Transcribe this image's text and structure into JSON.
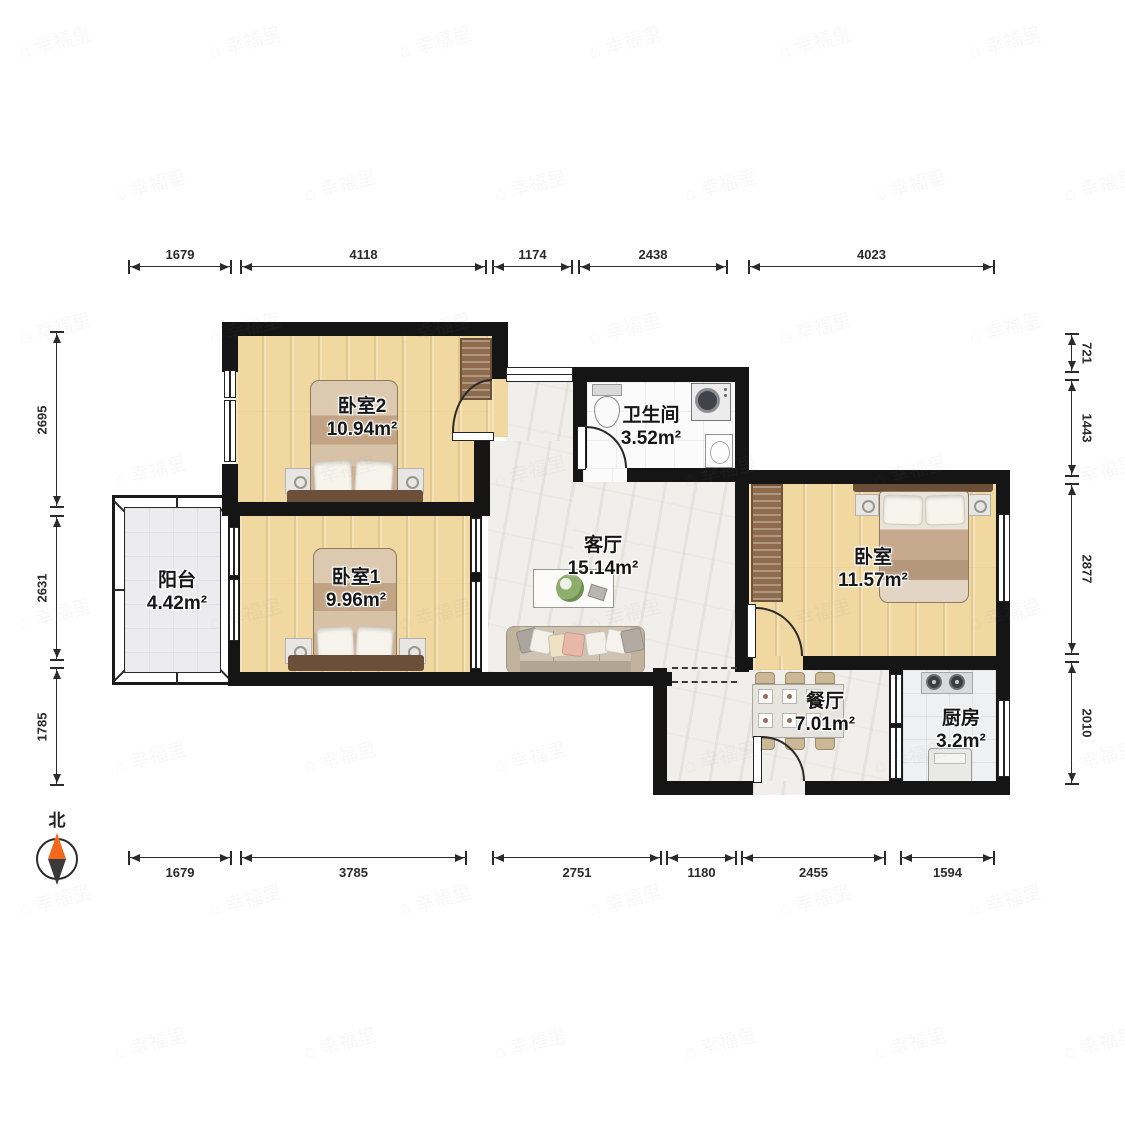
{
  "compass": {
    "north_label": "北"
  },
  "watermark": {
    "icon": "⌂",
    "text": "幸福里"
  },
  "colors": {
    "wall": "#151515",
    "wood_floor": "#f1d7a0",
    "marble_floor": "#f1efec",
    "compass_north": "#f2681c"
  },
  "rooms": [
    {
      "id": "bedroom2",
      "name": "卧室2",
      "area": "10.94m²",
      "cx": 362,
      "cy": 418
    },
    {
      "id": "bedroom1",
      "name": "卧室1",
      "area": "9.96m²",
      "cx": 356,
      "cy": 589
    },
    {
      "id": "balcony",
      "name": "阳台",
      "area": "4.42m²",
      "cx": 177,
      "cy": 592
    },
    {
      "id": "living",
      "name": "客厅",
      "area": "15.14m²",
      "cx": 603,
      "cy": 557
    },
    {
      "id": "bathroom",
      "name": "卫生间",
      "area": "3.52m²",
      "cx": 651,
      "cy": 427
    },
    {
      "id": "bedroom-r",
      "name": "卧室",
      "area": "11.57m²",
      "cx": 873,
      "cy": 569
    },
    {
      "id": "dining",
      "name": "餐厅",
      "area": "7.01m²",
      "cx": 825,
      "cy": 713
    },
    {
      "id": "kitchen",
      "name": "厨房",
      "area": "3.2m²",
      "cx": 961,
      "cy": 730
    }
  ],
  "dimensions": {
    "top": [
      {
        "label": "1679",
        "from": 128,
        "to": 232
      },
      {
        "label": "4118",
        "from": 240,
        "to": 487
      },
      {
        "label": "1174",
        "from": 492,
        "to": 573
      },
      {
        "label": "2438",
        "from": 578,
        "to": 728
      },
      {
        "label": "4023",
        "from": 748,
        "to": 995
      }
    ],
    "bottom": [
      {
        "label": "1679",
        "from": 128,
        "to": 232
      },
      {
        "label": "3785",
        "from": 240,
        "to": 467
      },
      {
        "label": "2751",
        "from": 492,
        "to": 662
      },
      {
        "label": "1180",
        "from": 666,
        "to": 737
      },
      {
        "label": "2455",
        "from": 741,
        "to": 886
      },
      {
        "label": "1594",
        "from": 900,
        "to": 995
      }
    ],
    "left": [
      {
        "label": "2695",
        "from": 331,
        "to": 508
      },
      {
        "label": "2631",
        "from": 515,
        "to": 661
      },
      {
        "label": "1785",
        "from": 667,
        "to": 786
      }
    ],
    "right": [
      {
        "label": "721",
        "from": 333,
        "to": 373
      },
      {
        "label": "1443",
        "from": 379,
        "to": 477
      },
      {
        "label": "2877",
        "from": 483,
        "to": 655
      },
      {
        "label": "2010",
        "from": 661,
        "to": 785
      }
    ]
  }
}
